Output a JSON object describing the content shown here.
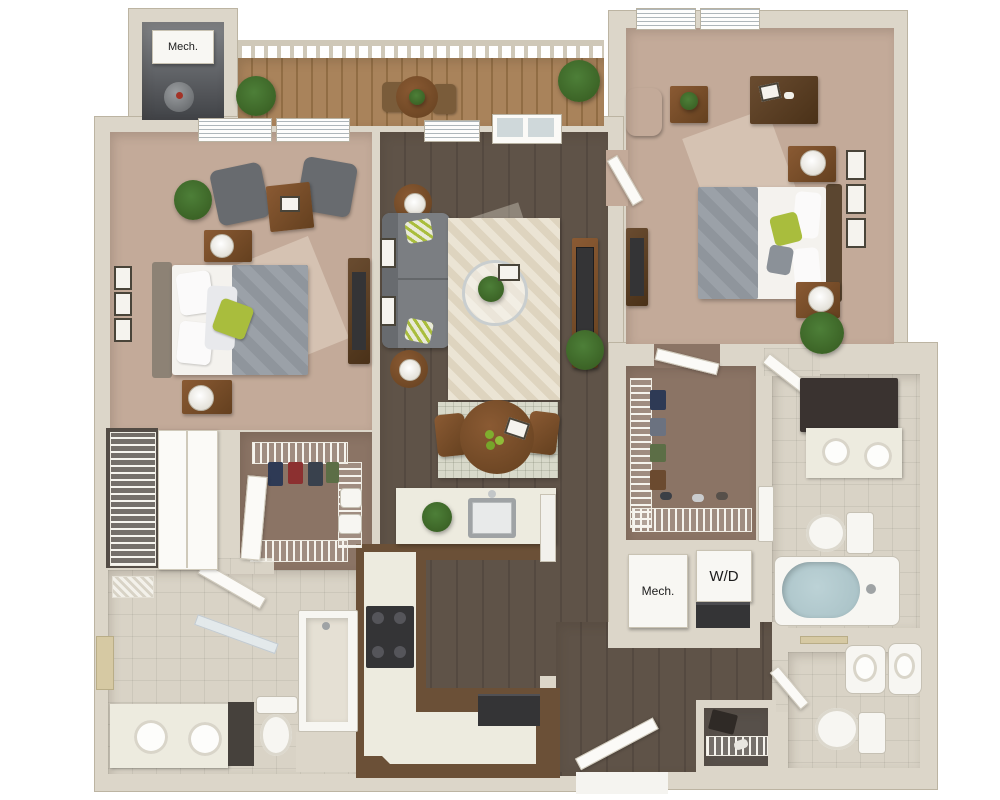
{
  "labels": {
    "mech_upper": "Mech.",
    "mech_lower": "Mech.",
    "washer_dryer": "W/D"
  },
  "palette": {
    "wall": "#dcd6c9",
    "wall_line": "#bcb4a2",
    "text": "#1c1c1c",
    "mech_floor_a": "#83868a",
    "mech_floor_b": "#404246",
    "deck": "#a9835b",
    "deck_dark": "#916d44",
    "rail": "#cfc8b8",
    "carpet": "#c3aa99",
    "carpet_light": "#d6c2b1",
    "wood": "#5f5348",
    "wood_dark": "#544940",
    "tile": "#d9d3c6",
    "closet_floor": "#8b7465",
    "closet_dark": "#57504a",
    "rug": "#ebe4d4",
    "rug_dark": "#ded4bf",
    "dining_rug": "#d8d9ca",
    "sofa": "#7b7e82",
    "sofa_dark": "#686b6f",
    "bed_gray": "#9ba1a8",
    "accent_green": "#a9bd3d",
    "plant": "#4d7f38",
    "plant_dark": "#35591f",
    "wood_furn": "#8a5a33",
    "wood_furn_dark": "#64401f",
    "counter": "#edebdf",
    "cabinet": "#6b5037",
    "appliance": "#343436",
    "white_fix": "#f7f6f2",
    "water": "#a7c0c5",
    "glass": "#cfd8da",
    "towel": "#d6c9a3"
  }
}
